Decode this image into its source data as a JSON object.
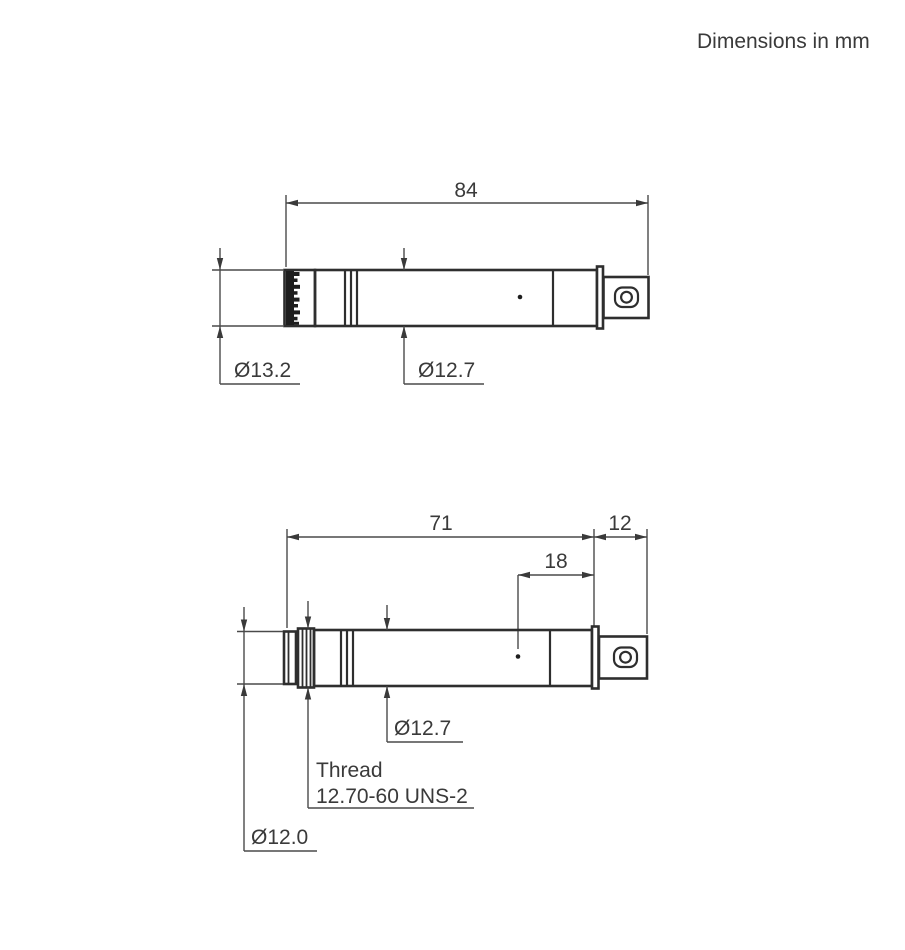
{
  "note": "Dimensions in mm",
  "colors": {
    "background": "#ffffff",
    "object_line": "#2e2e2e",
    "dimension_line": "#4a4a4a",
    "text": "#3a3a3a"
  },
  "top_view": {
    "description": "microphone-with-protection-grid",
    "length": "84",
    "grid_diameter": "Ø13.2",
    "body_diameter": "Ø12.7"
  },
  "bottom_view": {
    "description": "microphone-grid-removed",
    "body_length": "71",
    "connector_length": "12",
    "vent_to_end": "18",
    "body_diameter": "Ø12.7",
    "thread_line1": "Thread",
    "thread_line2": "12.70-60 UNS-2",
    "front_diameter": "Ø12.0"
  }
}
